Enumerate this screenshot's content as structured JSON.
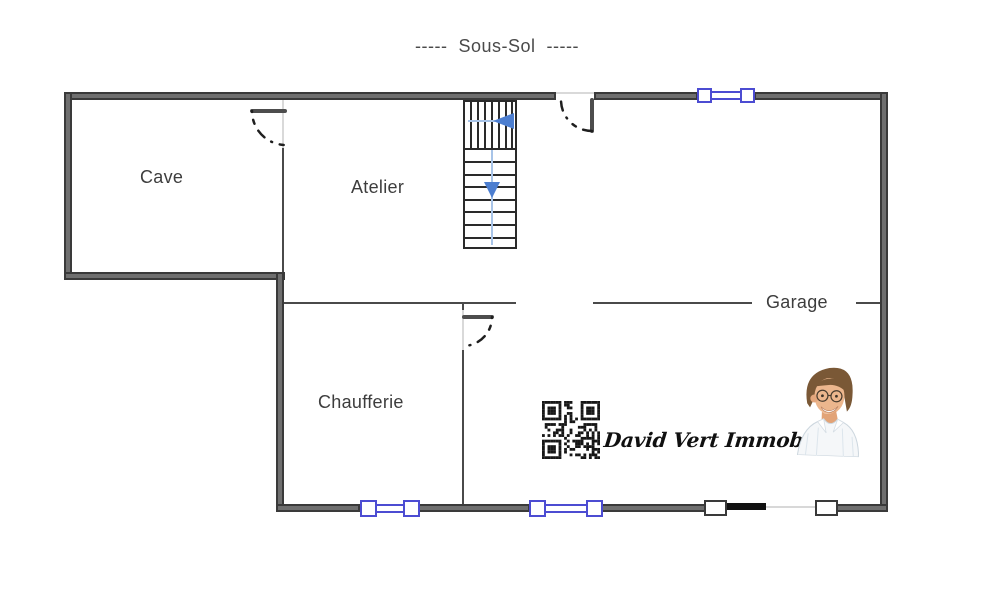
{
  "title": "-----  Sous-Sol  -----",
  "rooms": {
    "cave": "Cave",
    "atelier": "Atelier",
    "chaufferie": "Chaufferie",
    "garage": "Garage"
  },
  "branding": {
    "agency_name": "David Vert Immobilier"
  },
  "symbols": {
    "windows_count": 3,
    "door_swings_count": 3,
    "stair_direction": "down"
  },
  "colors": {
    "wall_fill": "#6f6f6f",
    "wall_edge": "#3a3a3a",
    "thin_wall": "#4a4a4a",
    "window_accent": "#4c4cd2",
    "stair_guide": "#a8c4e8",
    "stair_arrow": "#4c7ed0",
    "label_text": "#3d3d3d",
    "door_stroke": "#1f1f1f"
  }
}
